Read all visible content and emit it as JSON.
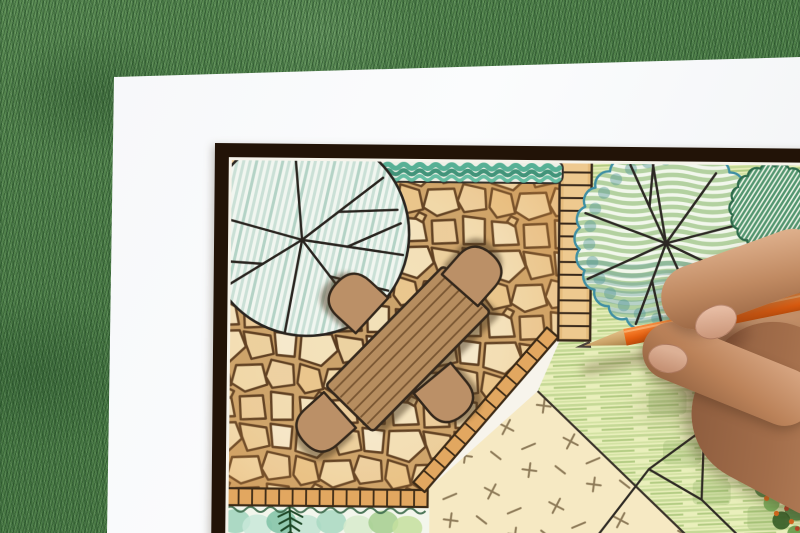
{
  "image": {
    "type": "photograph",
    "alt": "Hand holding an orange colored pencil while drawing a garden landscape architecture plan on a white sheet of paper lying on green grass"
  },
  "labels": {
    "grass": "grass lawn background",
    "paper": "white paper sheet",
    "plan": "garden landscape plan drawing",
    "hand": "hand holding pencil",
    "pencil": "orange colored pencil"
  },
  "plan_elements": {
    "frame": "dark plan border frame",
    "tree_left": "large round tree canopy with branch lines over patio",
    "tree_right": "large scalloped tree canopy on lawn",
    "shrub_right": "small hatched shrub canopy",
    "hedge_top": "clipped hedge strip along top edge",
    "patio": "irregular flagstone patio",
    "walkway": "plank walkway strip",
    "table": "rectangular wooden dining table",
    "chairs_count": 4,
    "gravel": "pale gravel area with cross hatch marks",
    "lawn": "pencil-hatched lawn",
    "planting_bed": "planting bed with fern and shrubs",
    "flower_bed": "flower bed cluster in corner",
    "edge_band": "brick edging band around patio",
    "rock_path": "stepping stone outlines on lawn"
  },
  "colors": {
    "grass_green": "#4f7d46",
    "paper_white": "#f7f8f9",
    "frame_dark": "#241509",
    "patio_tan": "#eed6a5",
    "stone_joint": "#54371d",
    "table_brown": "#b68d5f",
    "chair_brown": "#bb9067",
    "hedge_teal": "#3f9e80",
    "tree_hatch_teal": "#bcd8cc",
    "lawn_green": "#cfe0a0",
    "gravel_cream": "#f4e7c2",
    "pencil_orange": "#ef6c1a",
    "skin_tone": "#b5795a"
  }
}
